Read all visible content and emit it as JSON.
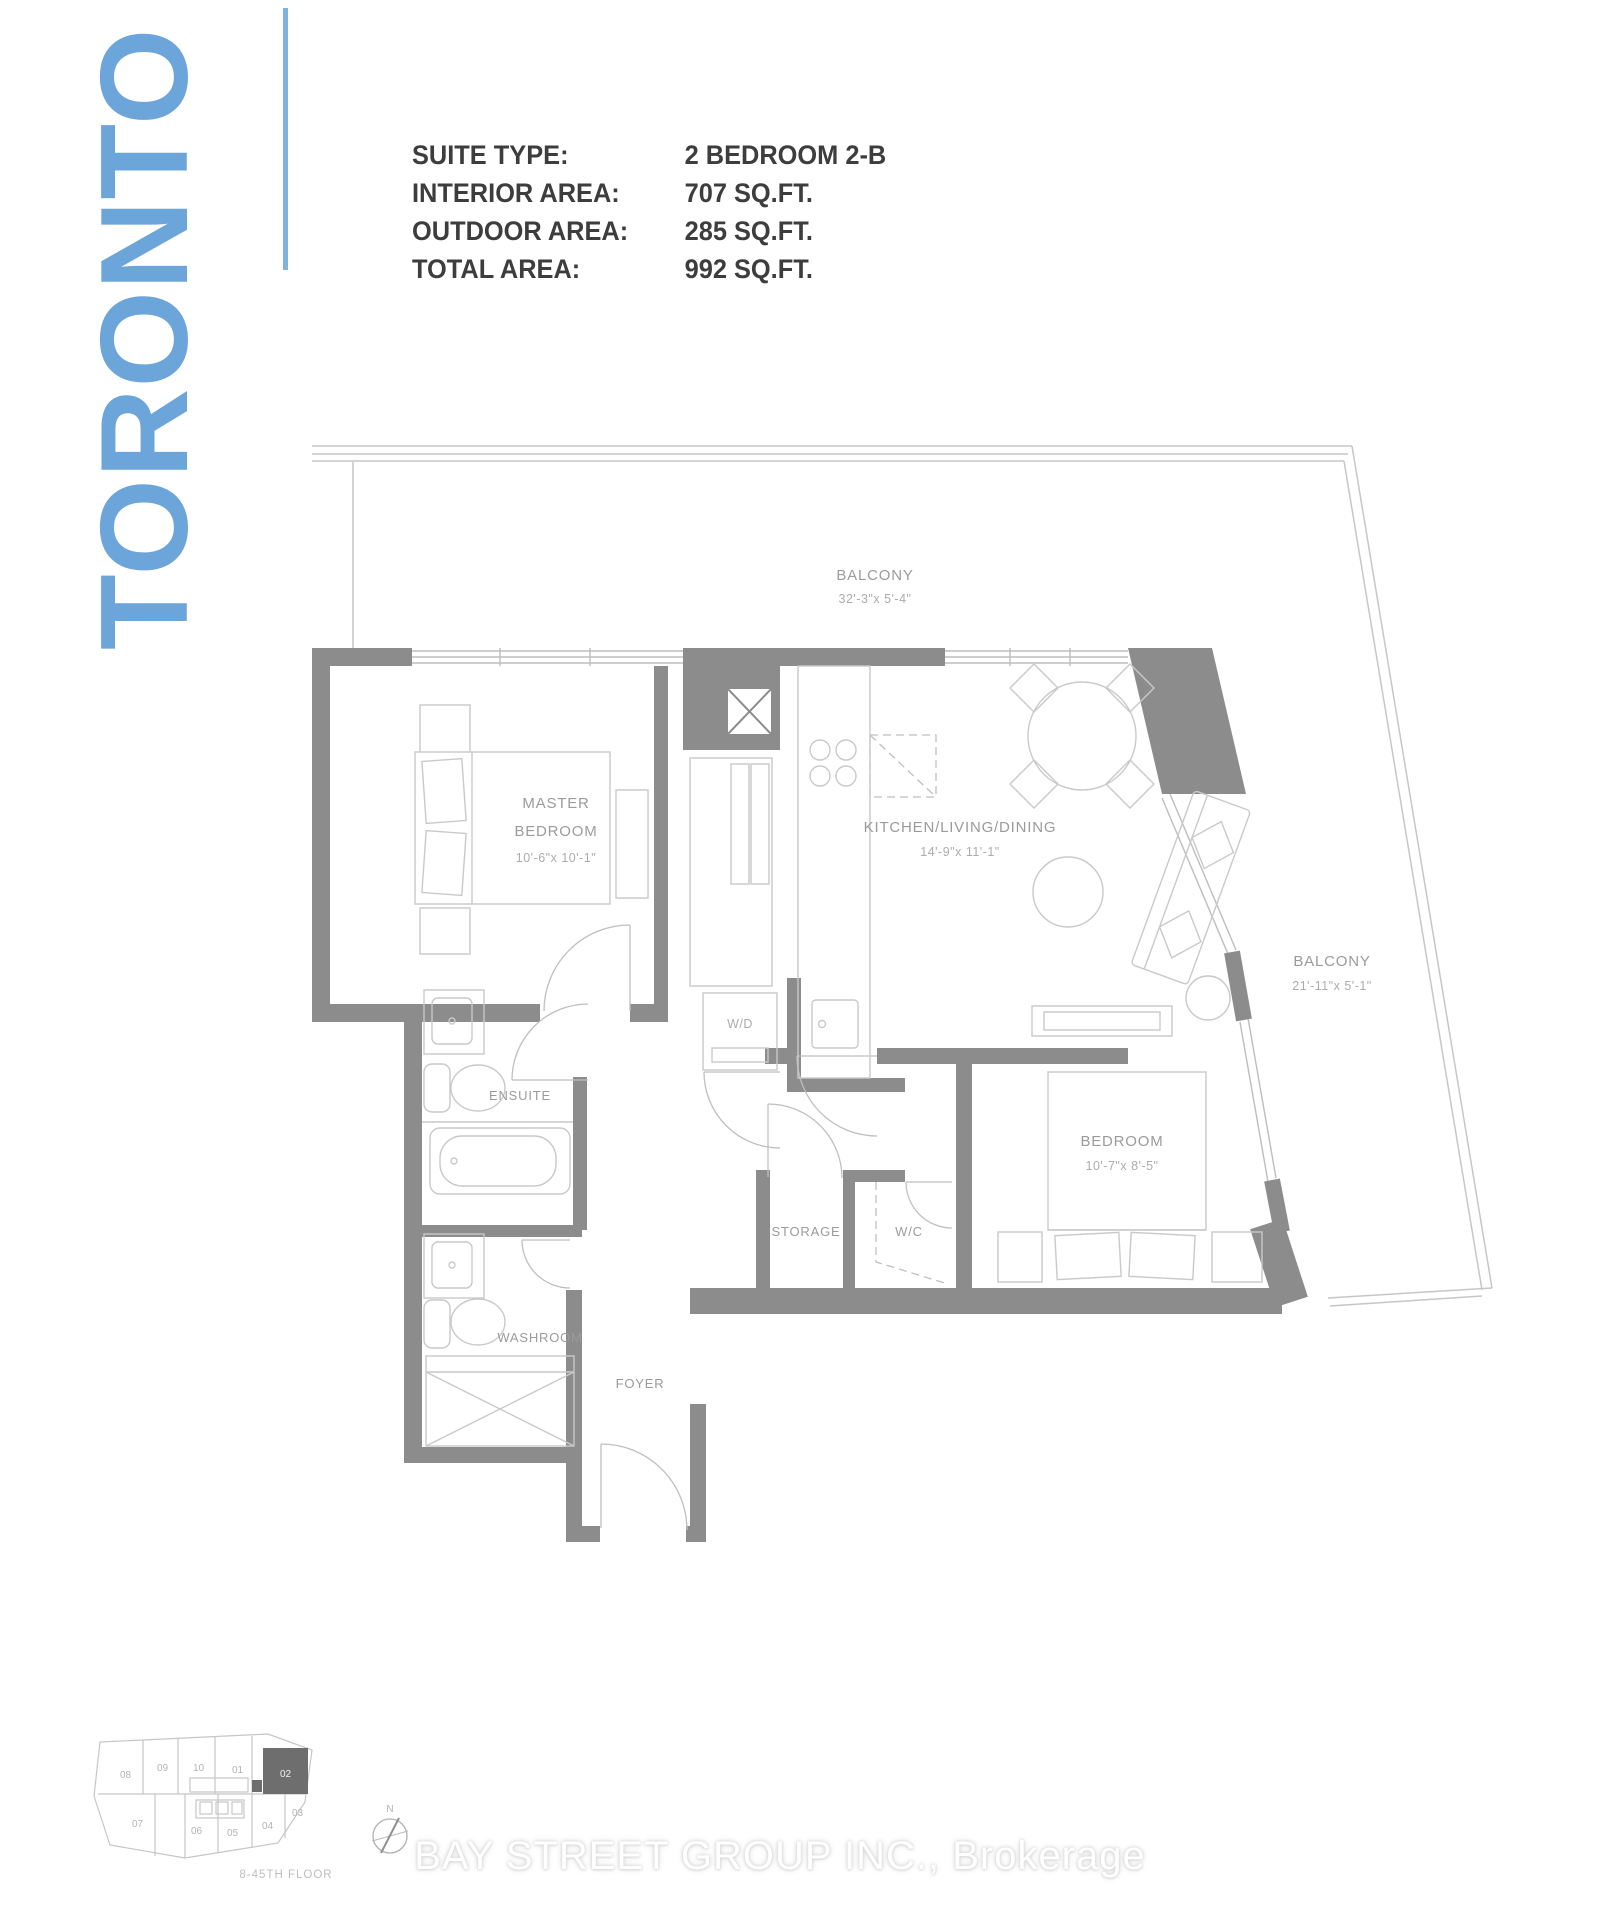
{
  "header": {
    "city_vertical": "TORONTO",
    "rows": [
      {
        "label": "SUITE TYPE:",
        "value": "2 BEDROOM 2-B"
      },
      {
        "label": "INTERIOR AREA:",
        "value": "707 SQ.FT."
      },
      {
        "label": "OUTDOOR AREA:",
        "value": "285 SQ.FT."
      },
      {
        "label": "TOTAL AREA:",
        "value": "992 SQ.FT."
      }
    ]
  },
  "plan": {
    "balcony_top": {
      "name": "BALCONY",
      "dims": "32'-3\"x 5'-4\""
    },
    "balcony_right": {
      "name": "BALCONY",
      "dims": "21'-11\"x 5'-1\""
    },
    "master_bedroom": {
      "name_line1": "MASTER",
      "name_line2": "BEDROOM",
      "dims": "10'-6\"x 10'-1\""
    },
    "kitchen_living_dining": {
      "name": "KITCHEN/LIVING/DINING",
      "dims": "14'-9\"x 11'-1\""
    },
    "bedroom": {
      "name": "BEDROOM",
      "dims": "10'-7\"x 8'-5\""
    },
    "ensuite": {
      "name": "ENSUITE"
    },
    "washroom": {
      "name": "WASHROOM"
    },
    "foyer": {
      "name": "FOYER"
    },
    "storage": {
      "name": "STORAGE"
    },
    "wc": {
      "name": "W/C"
    },
    "wd": {
      "name": "W/D"
    }
  },
  "key_plan": {
    "top_row": [
      "08",
      "09",
      "10",
      "01",
      "02"
    ],
    "bottom_row": [
      "07",
      "06",
      "05",
      "04",
      "03"
    ],
    "highlighted_unit": "02",
    "floor_note": "8-45TH FLOOR",
    "compass_north": "N"
  },
  "watermark": "BAY STREET GROUP INC., Brokerage",
  "colors": {
    "accent_blue": "#6CA5D9",
    "wall_gray": "#8C8C8C"
  }
}
